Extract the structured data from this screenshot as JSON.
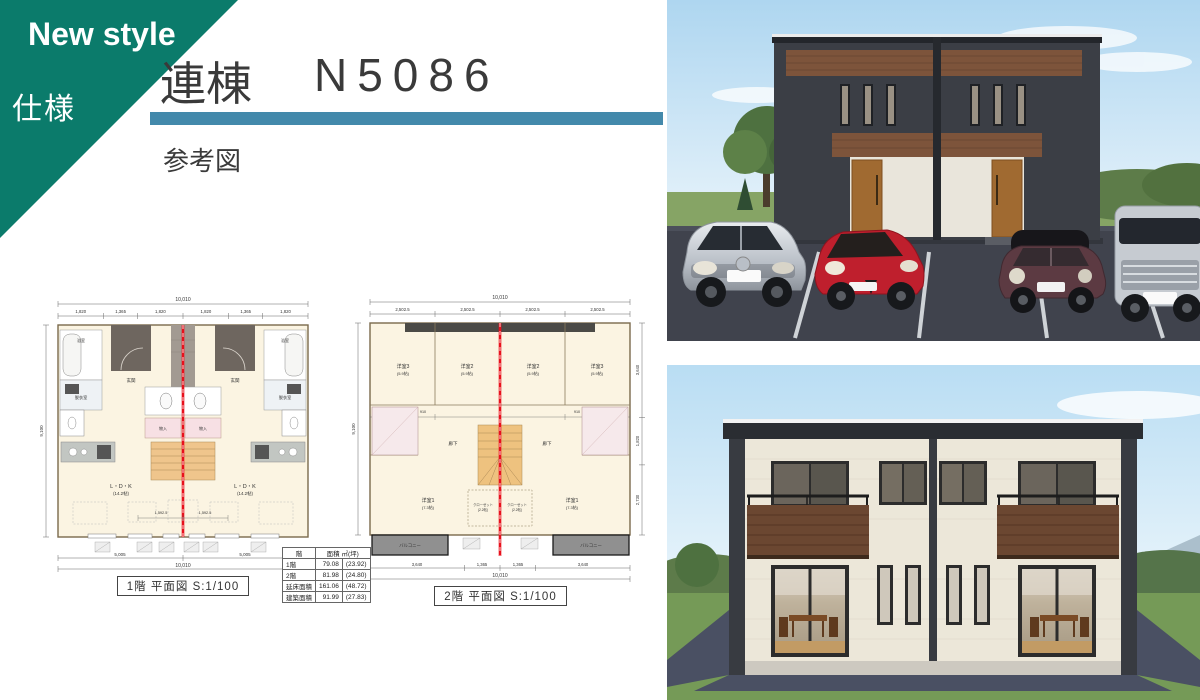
{
  "banner": {
    "line1": "New style",
    "line2": "仕様"
  },
  "header": {
    "model_type": "連棟",
    "model_no": "N5086",
    "subtitle": "参考図"
  },
  "plan1": {
    "caption": "1階  平面図  S:1/100",
    "dims": {
      "top_total": "10,010",
      "top_segments": [
        "1,820",
        "1,365",
        "1,820",
        "1,820",
        "1,365",
        "1,820"
      ],
      "center_segments": [
        "1,592.5",
        "1,592.5"
      ],
      "bottom_halves": [
        "5,005",
        "5,005"
      ],
      "bottom_total": "10,010",
      "side_total": "9,100"
    },
    "rooms": {
      "genkan": "玄関",
      "bath": "浴室",
      "datsuishitsu": "脱衣室",
      "ldk": "L・D・K",
      "ldk_size": "(14.2帖)",
      "monoire": "物入"
    }
  },
  "plan2": {
    "caption": "2階  平面図  S:1/100",
    "dims": {
      "top_total": "10,010",
      "top_segments": [
        "2,502.5",
        "2,502.5",
        "2,502.5",
        "2,502.5"
      ],
      "center_segments": [
        "1,592.5",
        "910",
        "910",
        "1,592.5"
      ],
      "bottom_segments": [
        "3,640",
        "1,365",
        "1,365",
        "3,640"
      ],
      "bottom_total": "10,010",
      "side_total": "9,100",
      "right_segments": [
        "3,640",
        "1,820",
        "2,730"
      ]
    },
    "rooms": {
      "yoshitsu3": "洋室3",
      "yoshitsu3_size": "(5.9帖)",
      "yoshitsu2": "洋室2",
      "yoshitsu2_size": "(5.9帖)",
      "yoshitsu1": "洋室1",
      "yoshitsu1_size": "(7.3帖)",
      "rouka": "廊下",
      "closet": "クローゼット",
      "closet_size": "(2.2帖)",
      "balcony": "バルコニー"
    }
  },
  "area_table": {
    "col_floor": "階",
    "col_area": "面積  ㎡(坪)",
    "rows": [
      {
        "label": "1階",
        "sqm": "79.08",
        "tsubo": "(23.92)"
      },
      {
        "label": "2階",
        "sqm": "81.98",
        "tsubo": "(24.80)"
      },
      {
        "label": "延床面積",
        "sqm": "161.06",
        "tsubo": "(48.72)"
      },
      {
        "label": "建築面積",
        "sqm": "91.99",
        "tsubo": "(27.83)"
      }
    ]
  },
  "colors": {
    "banner_teal": "#0b7b6b",
    "title_bar_blue": "#4389ab",
    "party_wall_red": "#e8101c",
    "plan_cream": "#fbf4e2",
    "exterior_dark": "#3b3e45",
    "accent_wood_brown": "#7d543b",
    "exterior_cream": "#ece7d9",
    "balcony_brown": "#6b4731"
  }
}
